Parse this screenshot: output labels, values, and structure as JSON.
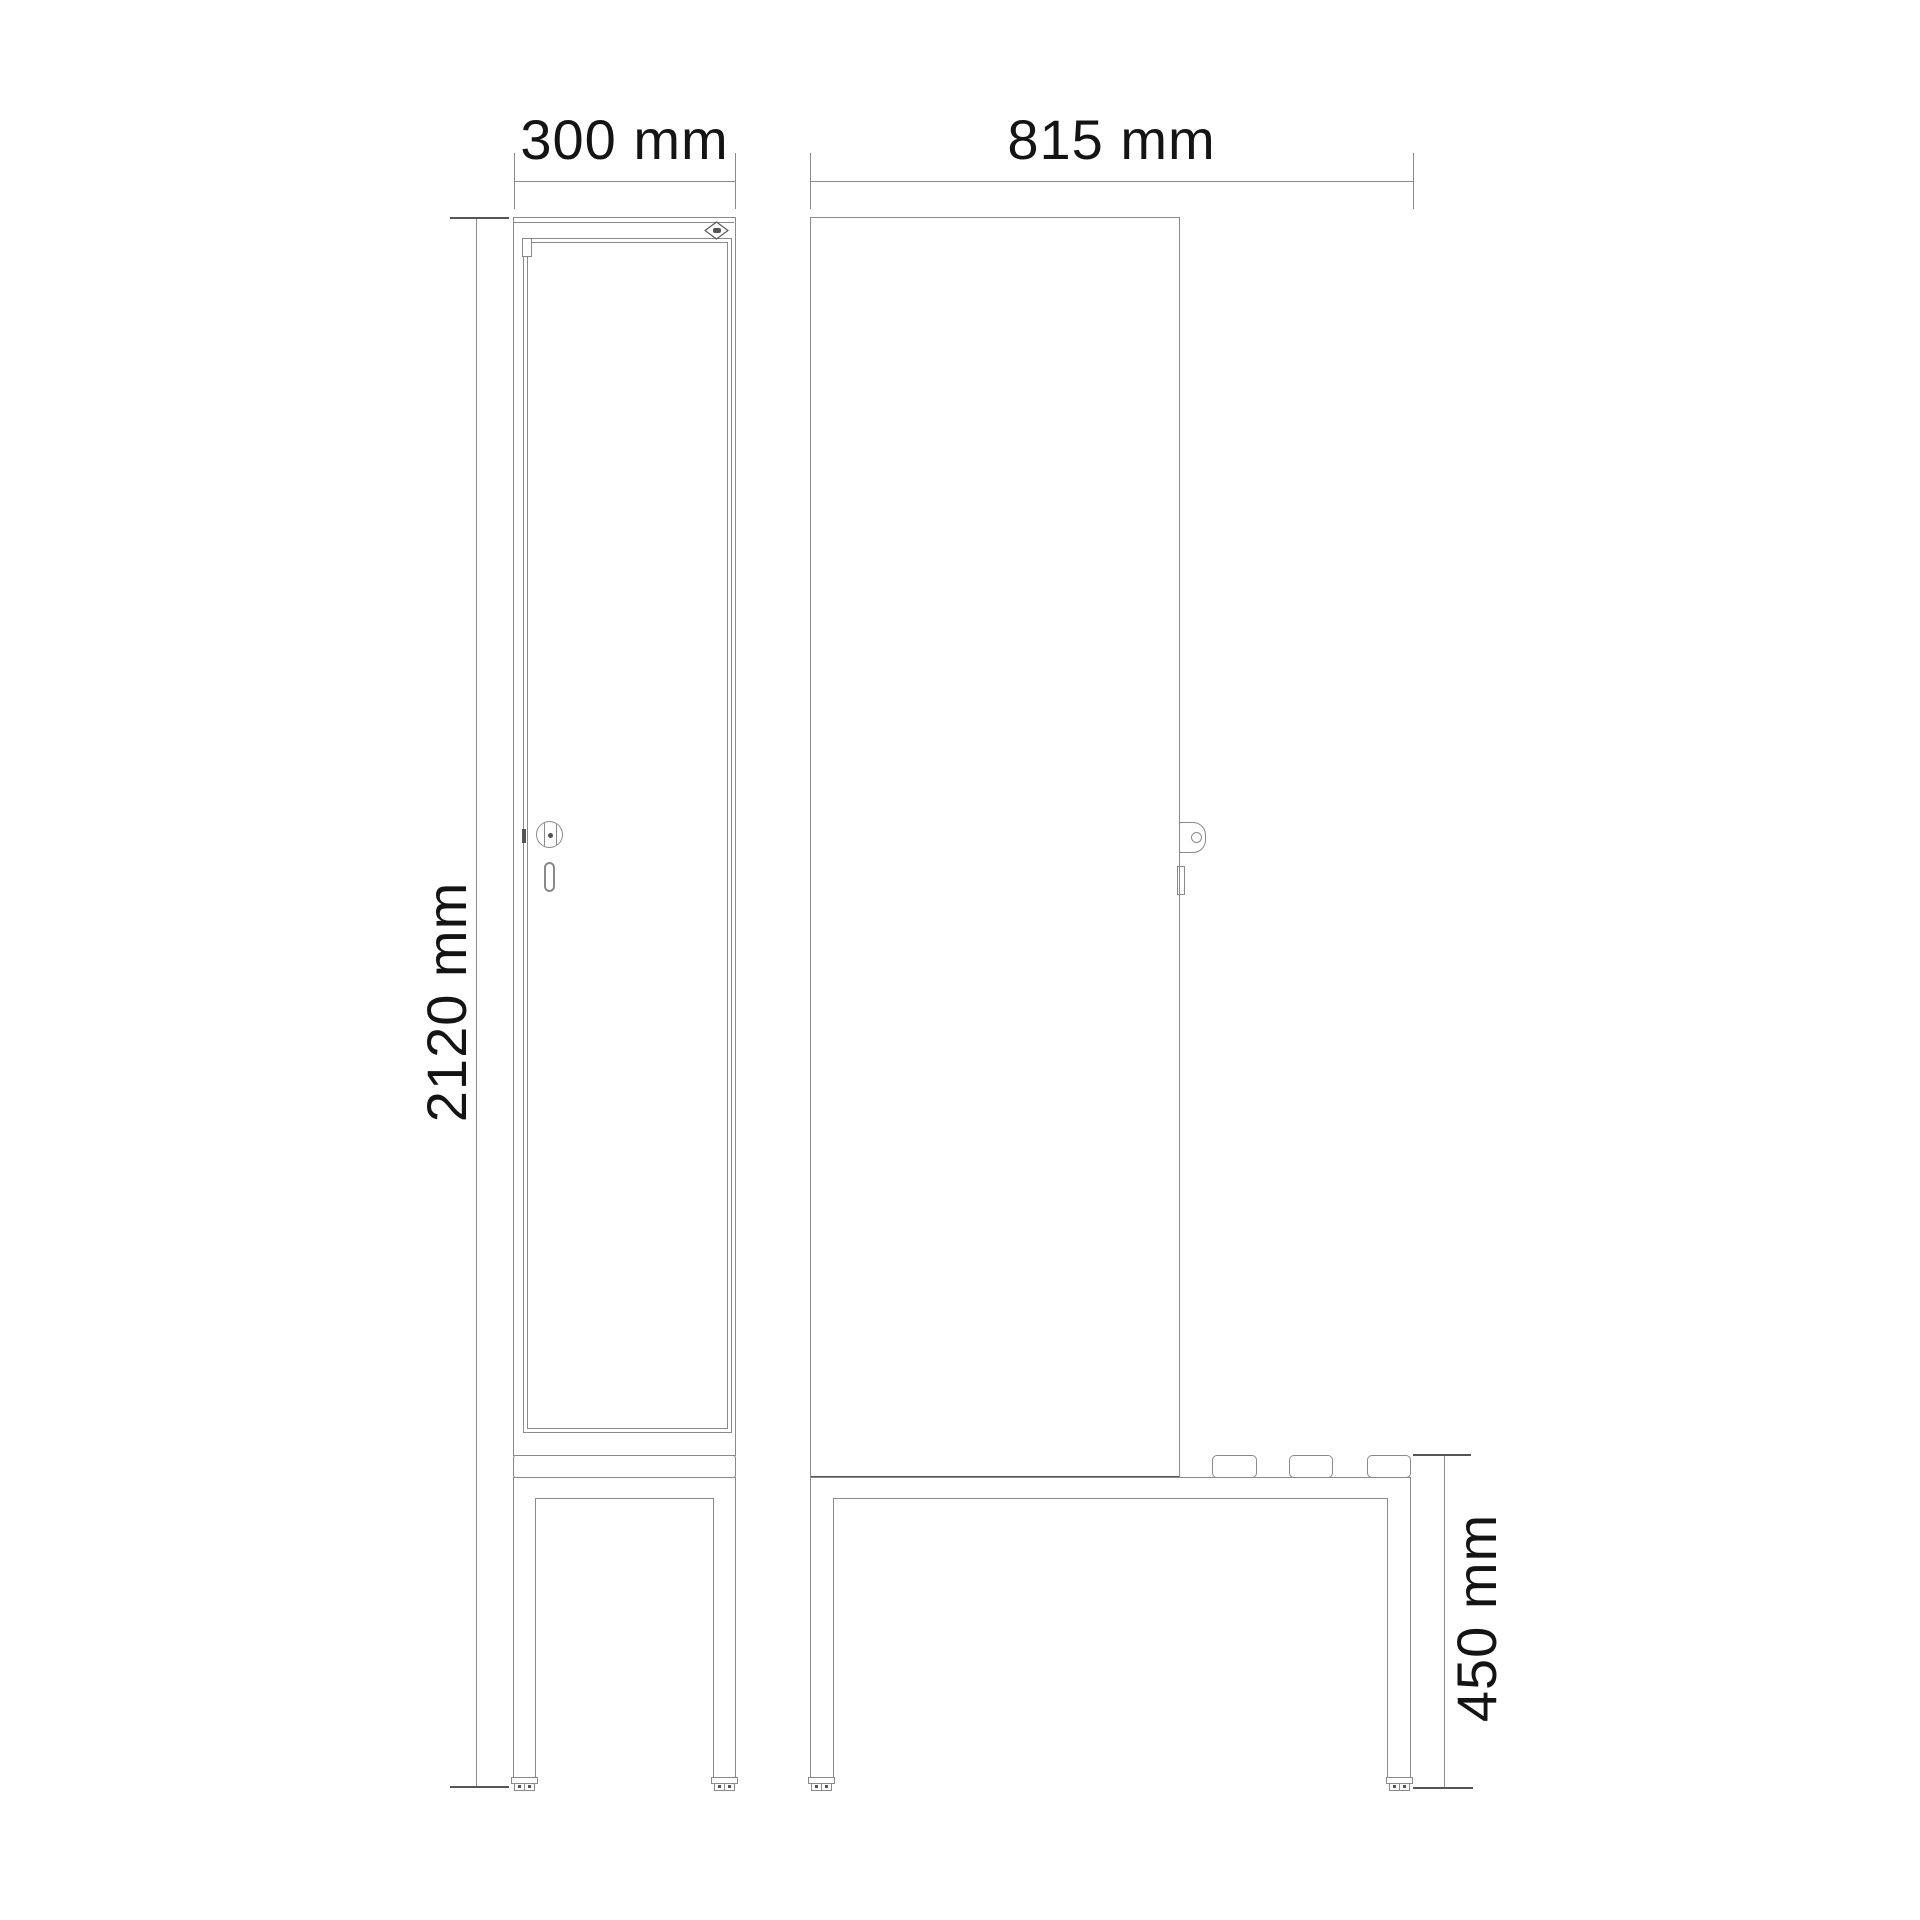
{
  "drawing": {
    "dimensions": {
      "front_width": "300 mm",
      "total_depth": "815 mm",
      "total_height": "2120 mm",
      "bench_height": "450 mm"
    },
    "icons": {
      "brand_logo": "diamond-badge-icon",
      "lock_front": "cylinder-lock-icon",
      "lock_side": "lock-tab-icon",
      "handle": "handle-slot-icon"
    },
    "colors": {
      "background": "#ffffff",
      "line": "#8a8a8a",
      "line-dark": "#555555",
      "text": "#141414"
    }
  }
}
